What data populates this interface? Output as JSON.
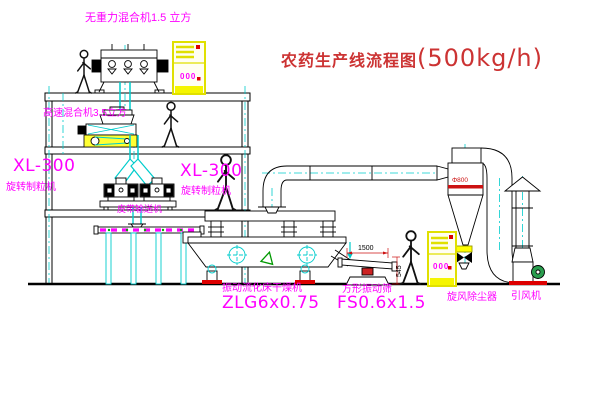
{
  "title": {
    "name": "农药生产线流程图",
    "capacity": "(500kg/h)"
  },
  "labels": {
    "top_mixer": "无重力混合机1.5 立方",
    "mid_mixer": "高速混合机3.5立方",
    "granulator_model": "XL-300",
    "granulator_name": "旋转制粒机",
    "belt_conveyor": "皮带输送机",
    "dryer_name": "振动流化床干燥机",
    "dryer_model": "ZLG6x0.75",
    "sieve_name": "方形振动筛",
    "sieve_model": "FS0.6x1.5",
    "cyclone_name": "旋风除尘器",
    "fan_name": "引风机"
  },
  "dimensions": {
    "sieve_width": "1500",
    "sieve_height": "545",
    "cyclone_dia": "Φ800"
  },
  "cabinets": {
    "display": "000"
  },
  "colors": {
    "label_magenta": "#ff00ff",
    "title_red": "#cc3333",
    "centerline_cyan": "#00cccc",
    "cabinet_yellow": "#f0f000",
    "alert_red": "#dd0000",
    "motor_green": "#2a9d4e"
  }
}
